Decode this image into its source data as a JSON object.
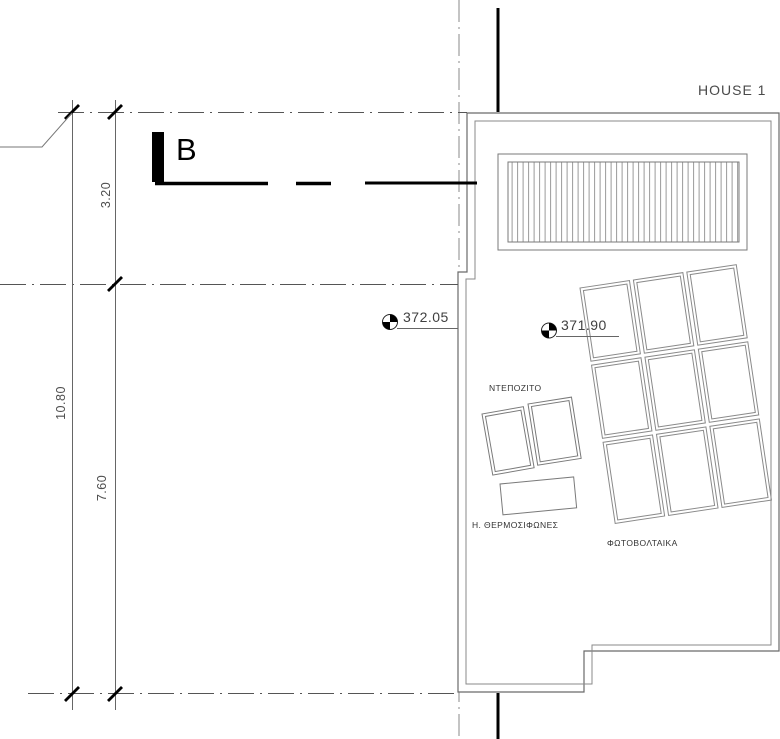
{
  "page": {
    "title": "HOUSE 1",
    "section": {
      "label": "B"
    },
    "dimensions": {
      "upper": "3.20",
      "total": "10.80",
      "lower": "7.60"
    },
    "elevations": {
      "left": "372.05",
      "right": "371.90"
    },
    "equipment": {
      "tank": "ΝΤΕΠΟΖΙΤΟ",
      "heaters": "Η. ΘΕΡΜΟΣΙΦΩΝΕΣ",
      "photovoltaics": "ΦΩΤΟΒΟΛΤΑΙΚΑ"
    },
    "colors": {
      "line": "#6a6a6a",
      "dark": "#000000",
      "text": "#3a3a3a"
    }
  }
}
